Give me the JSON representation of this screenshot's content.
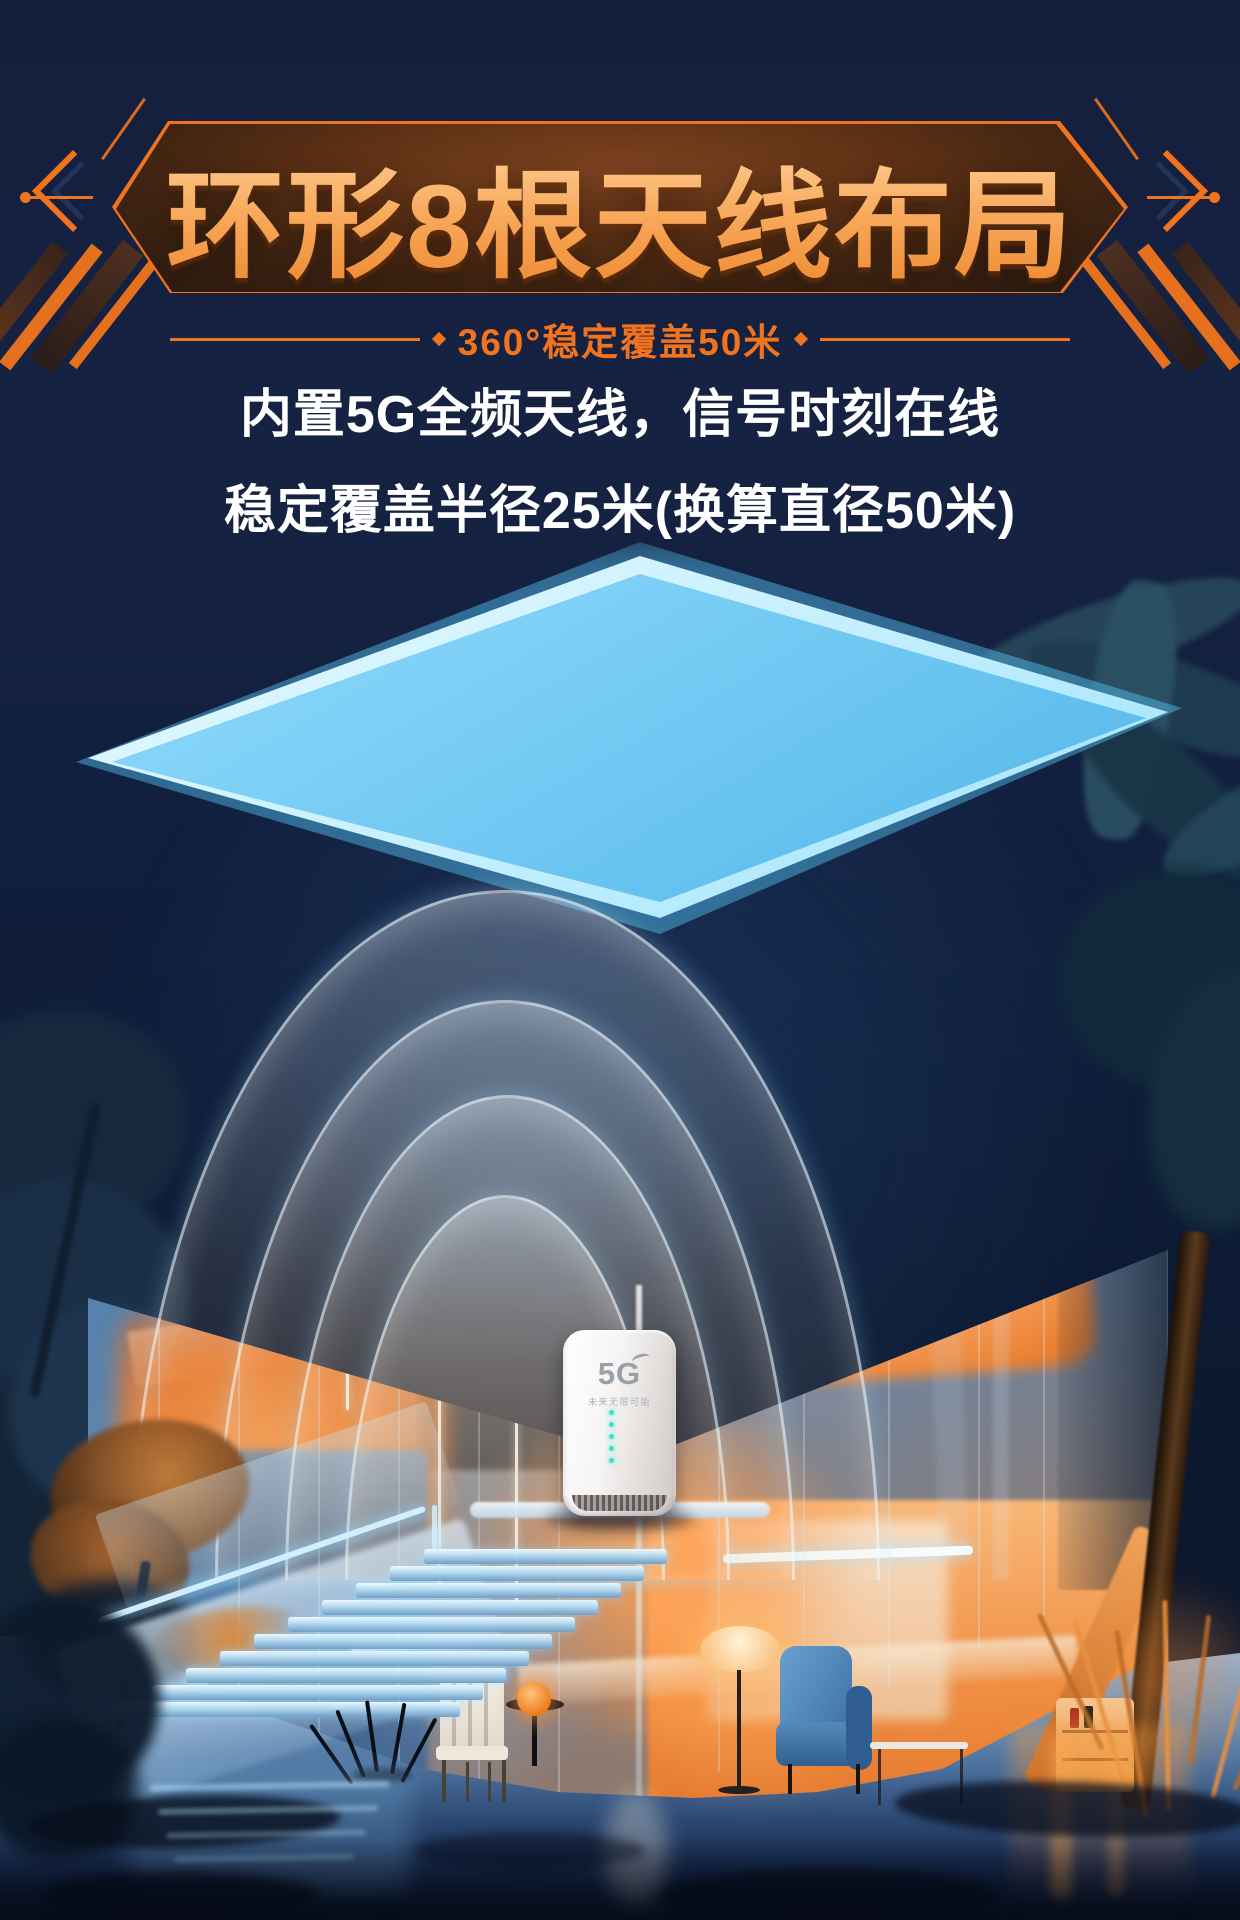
{
  "poster": {
    "title": "环形8根天线布局",
    "subtitle": "360°稳定覆盖50米",
    "description": [
      "内置5G全频天线，信号时刻在线",
      "稳定覆盖半径25米(换算直径50米)"
    ]
  },
  "router": {
    "logo": "5G",
    "tagline": "未来无限可能",
    "led_count": 5
  },
  "colors": {
    "background_navy": "#131f3e",
    "banner_orange": "#f2731d",
    "title_orange": "#f8a95c",
    "text_white": "#ffffff",
    "neon_cyan": "#8fdcff",
    "interior_orange": "#f08032",
    "led_teal": "#3fe0c9"
  }
}
